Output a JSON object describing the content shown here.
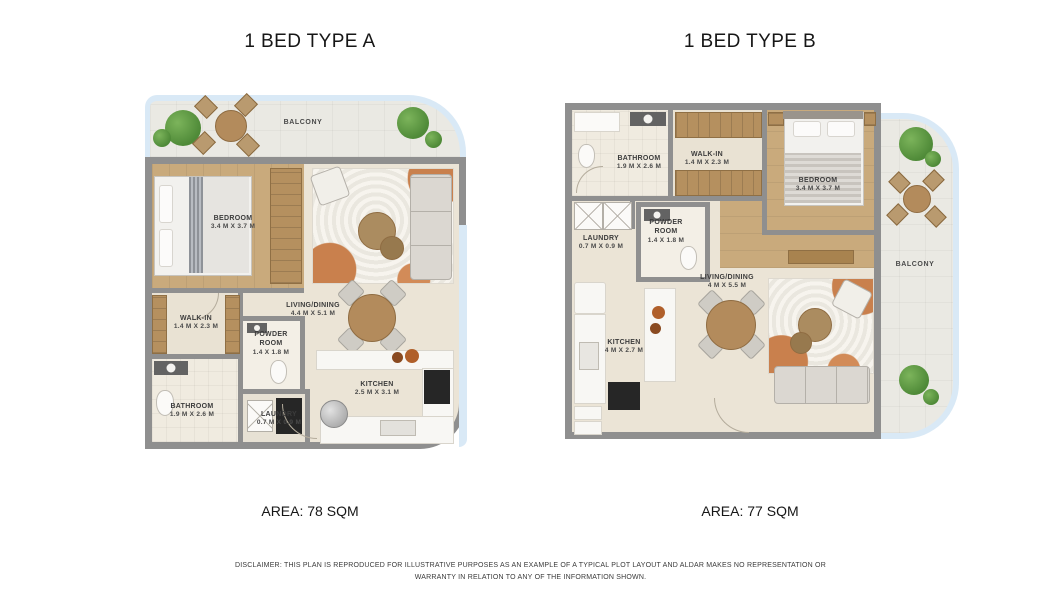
{
  "colors": {
    "wall": "#8f8f8f",
    "floor": "#ebe4d6",
    "wood": "#c9aa7c",
    "glass_railing": "#d9e9f6",
    "balcony_floor": "#eae9e3",
    "rug_accent": "#c9804d",
    "plant_green": "#4f8a38",
    "text": "#161616"
  },
  "plans": [
    {
      "title": "1 BED TYPE A",
      "area": "AREA: 78 SQM",
      "balcony_label": "BALCONY",
      "rooms": {
        "bedroom": {
          "name": "BEDROOM",
          "dims": "3.4 M X 3.7 M"
        },
        "walk_in": {
          "name": "WALK-IN",
          "dims": "1.4 M X 2.3 M"
        },
        "bathroom": {
          "name": "BATHROOM",
          "dims": "1.9 M X 2.6 M"
        },
        "powder_room": {
          "name": "POWDER ROOM",
          "dims": "1.4 X 1.8 M"
        },
        "laundry": {
          "name": "LAUNDRY",
          "dims": "0.7 M X 0.9 M"
        },
        "living_dining": {
          "name": "LIVING/DINING",
          "dims": "4.4 M X 5.1 M"
        },
        "kitchen": {
          "name": "KITCHEN",
          "dims": "2.5 M X 3.1 M"
        }
      }
    },
    {
      "title": "1 BED TYPE B",
      "area": "AREA: 77 SQM",
      "balcony_label": "BALCONY",
      "rooms": {
        "bathroom": {
          "name": "BATHROOM",
          "dims": "1.9 M X 2.6 M"
        },
        "walk_in": {
          "name": "WALK-IN",
          "dims": "1.4 M X 2.3 M"
        },
        "bedroom": {
          "name": "BEDROOM",
          "dims": "3.4 M X 3.7 M"
        },
        "laundry": {
          "name": "LAUNDRY",
          "dims": "0.7 M X 0.9 M"
        },
        "powder_room": {
          "name": "POWDER ROOM",
          "dims": "1.4 X 1.8 M"
        },
        "kitchen": {
          "name": "KITCHEN",
          "dims": "4 M X 2.7 M"
        },
        "living_dining": {
          "name": "LIVING/DINING",
          "dims": "4 M X 5.5 M"
        }
      }
    }
  ],
  "disclaimer": "DISCLAIMER: THIS PLAN IS REPRODUCED FOR ILLUSTRATIVE PURPOSES AS AN EXAMPLE OF A TYPICAL PLOT LAYOUT AND ALDAR MAKES NO REPRESENTATION OR WARRANTY IN RELATION TO ANY OF THE INFORMATION SHOWN."
}
